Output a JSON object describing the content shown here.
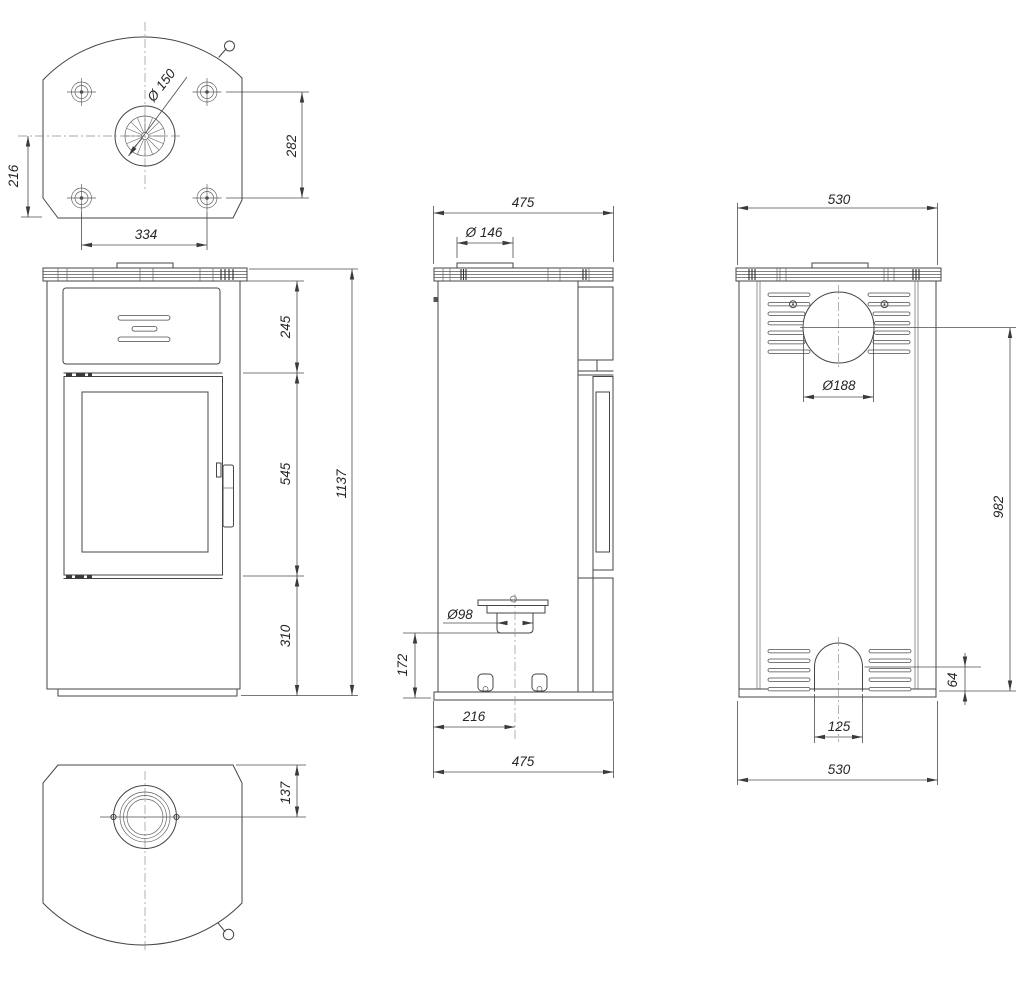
{
  "drawing": {
    "type": "stove-technical-drawing",
    "views": {
      "top": {
        "name": "top-view",
        "dims": {
          "flue_diameter": "Ø 150",
          "vertical_282": "282",
          "vertical_216": "216",
          "horizontal_334": "334"
        }
      },
      "front": {
        "name": "front-view",
        "dims": {
          "upper_section": "245",
          "door_section": "545",
          "lower_section": "310",
          "total_height": "1137"
        }
      },
      "side": {
        "name": "side-view",
        "dims": {
          "top_depth": "475",
          "collar_diameter": "Ø 146",
          "inlet_diameter": "Ø98",
          "inlet_height": "172",
          "inlet_offset": "216",
          "bottom_depth": "475"
        }
      },
      "back": {
        "name": "back-view",
        "dims": {
          "top_width": "530",
          "flue_hole_diameter": "Ø188",
          "flue_center_height": "982",
          "plinth_height": "64",
          "arch_width": "125",
          "bottom_width": "530"
        }
      },
      "bottom": {
        "name": "bottom-view",
        "dims": {
          "inlet_offset": "137"
        }
      }
    }
  }
}
